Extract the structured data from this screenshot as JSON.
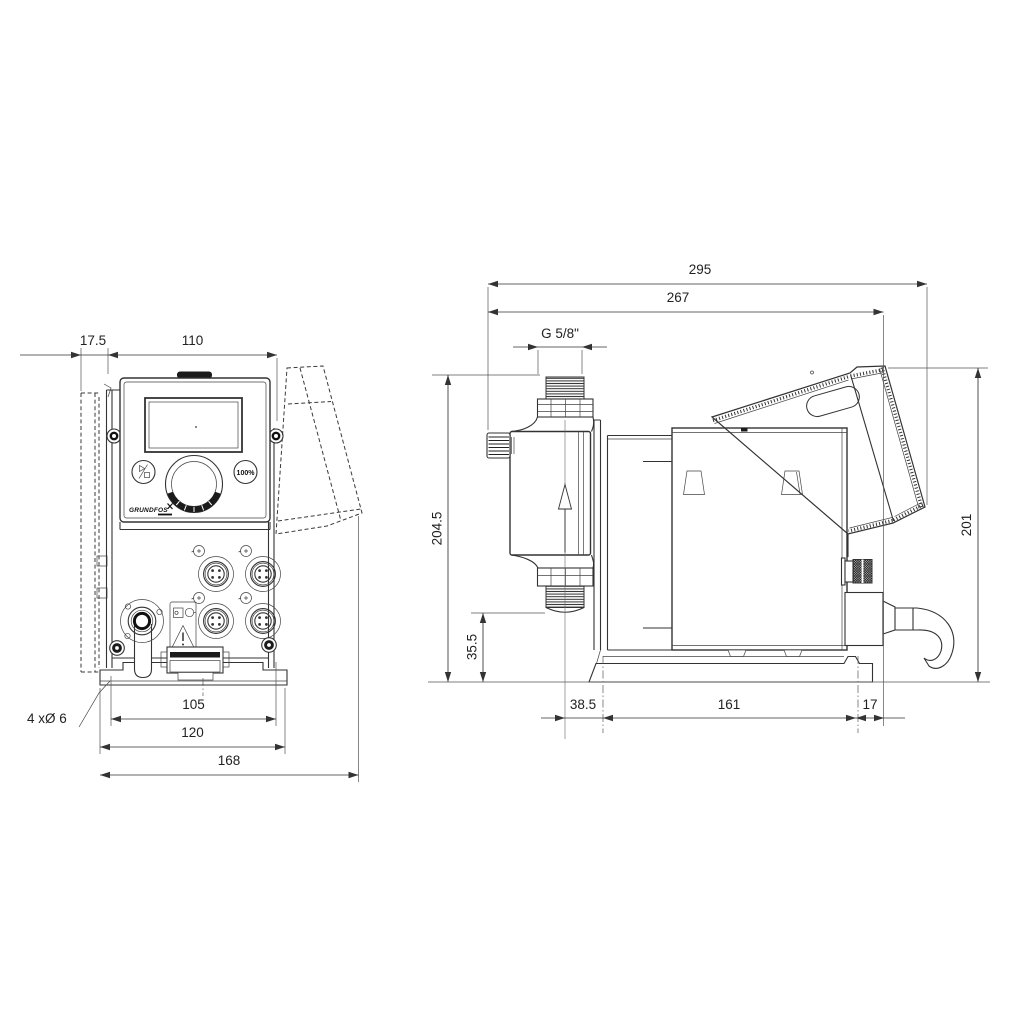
{
  "drawing": {
    "front_view": {
      "dim_plate_offset": "17.5",
      "dim_panel_width": "110",
      "dim_hole_spacing": "105",
      "dim_base_width": "120",
      "dim_total_width": "168",
      "holes_note": "4 xØ 6",
      "button_100": "100%",
      "logo": "GRUNDFOS"
    },
    "side_view": {
      "dim_total_depth": "295",
      "dim_depth_to_cable": "267",
      "dim_thread": "G 5/8\"",
      "dim_height": "204.5",
      "dim_outlet_height": "35.5",
      "dim_hood_height": "201",
      "dim_base_offset": "38.5",
      "dim_base_length": "161",
      "dim_base_rear": "17"
    }
  }
}
